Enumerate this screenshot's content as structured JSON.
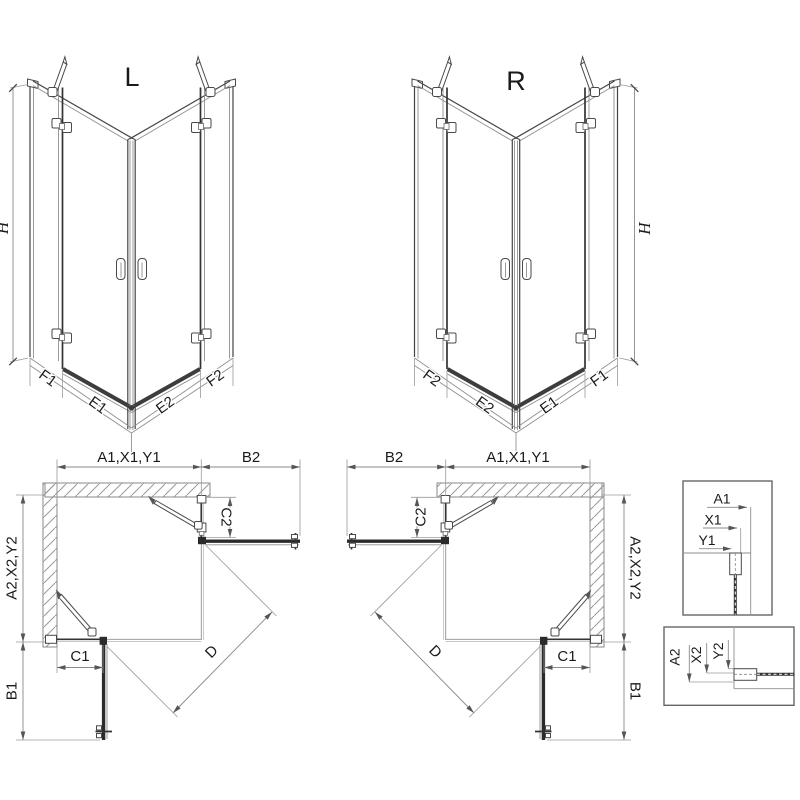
{
  "drawing": {
    "front_left": {
      "title": "L",
      "height": "H",
      "seg1": "F1",
      "seg2": "E1",
      "seg3": "E2",
      "seg4": "F2"
    },
    "front_right": {
      "title": "R",
      "height": "H",
      "seg1": "F2",
      "seg2": "E2",
      "seg3": "E1",
      "seg4": "F1"
    },
    "plan_left": {
      "width_top": "A1,X1,Y1",
      "door_top": "B2",
      "fixed_top": "C2",
      "depth_side": "A2,X2,Y2",
      "fixed_side": "C1",
      "door_side": "B1",
      "diagonal": "D"
    },
    "plan_right": {
      "width_top": "A1,X1,Y1",
      "door_top": "B2",
      "fixed_top": "C2",
      "depth_side": "A2,X2,Y2",
      "fixed_side": "C1",
      "door_side": "B1",
      "diagonal": "D"
    },
    "detail_top": {
      "d1": "A1",
      "d2": "X1",
      "d3": "Y1"
    },
    "detail_bottom": {
      "d1": "A2",
      "d2": "X2",
      "d3": "Y2"
    }
  },
  "colors": {
    "line": "#444444",
    "dark": "#2b2b2b",
    "dimension": "#8a8a8a",
    "hatch": "#9a9a9a",
    "background": "#ffffff"
  }
}
